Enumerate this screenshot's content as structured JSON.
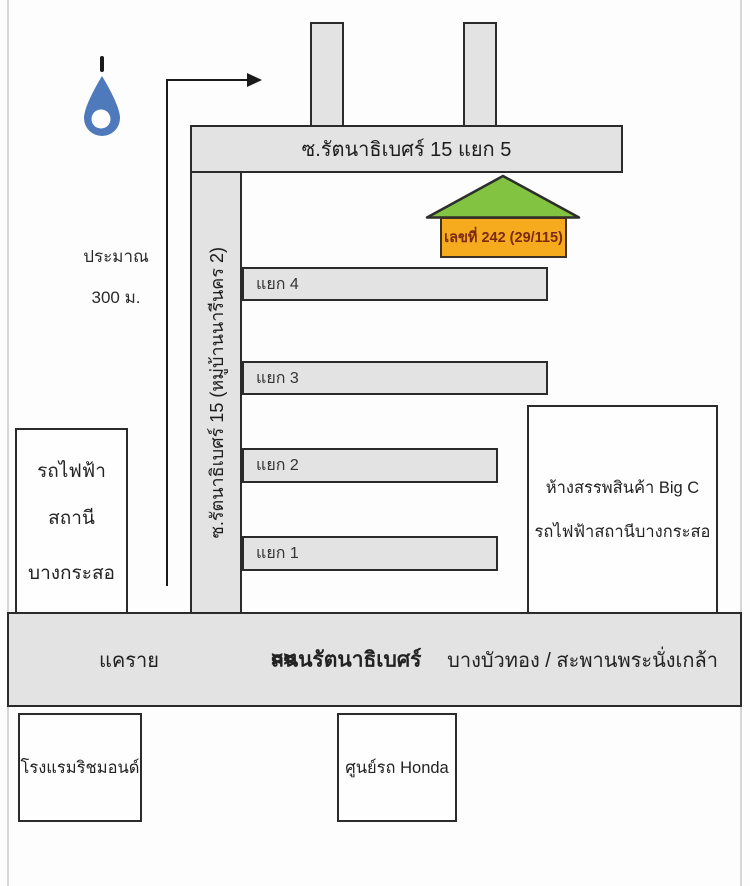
{
  "map": {
    "pin": {
      "icon": "location-pin"
    },
    "approx_note": {
      "line1": "ประมาณ",
      "line2": "300 ม."
    },
    "top_road": {
      "label": "ซ.รัตนาธิเบศร์ 15 แยก 5"
    },
    "vertical_road": {
      "label": "ซ.รัตนาธิเบศร์ 15 (หมู่บ้านนารีนคร 2)"
    },
    "house": {
      "label": "เลขที่ 242 (29/115)"
    },
    "branch_roads": [
      {
        "label": "แยก 4"
      },
      {
        "label": "แยก 3"
      },
      {
        "label": "แยก 2"
      },
      {
        "label": "แยก 1"
      }
    ],
    "station_box": {
      "line1": "รถไฟฟ้า",
      "line2": "สถานี",
      "line3": "บางกระสอ"
    },
    "bigc_box": {
      "line1": "ห้างสรรพสินค้า Big C",
      "line2": "รถไฟฟ้าสถานีบางกระสอ"
    },
    "main_road": {
      "left": "แคราย",
      "center_pre": "<<",
      "center_name": "ถนนรัตนาธิเบศร์",
      "center_post": ">>",
      "right": "บางบัวทอง / สะพานพระนั่งเกล้า"
    },
    "hotel_box": {
      "label": "โรงแรมริชมอนด์"
    },
    "honda_box": {
      "label": "ศูนย์รถ Honda"
    },
    "colors": {
      "road": "#e3e3e3",
      "road_border": "#2b2b2b",
      "roof_green": "#82c341",
      "house_body": "#f6ab1e",
      "pin_blue": "#4e79bb"
    }
  }
}
